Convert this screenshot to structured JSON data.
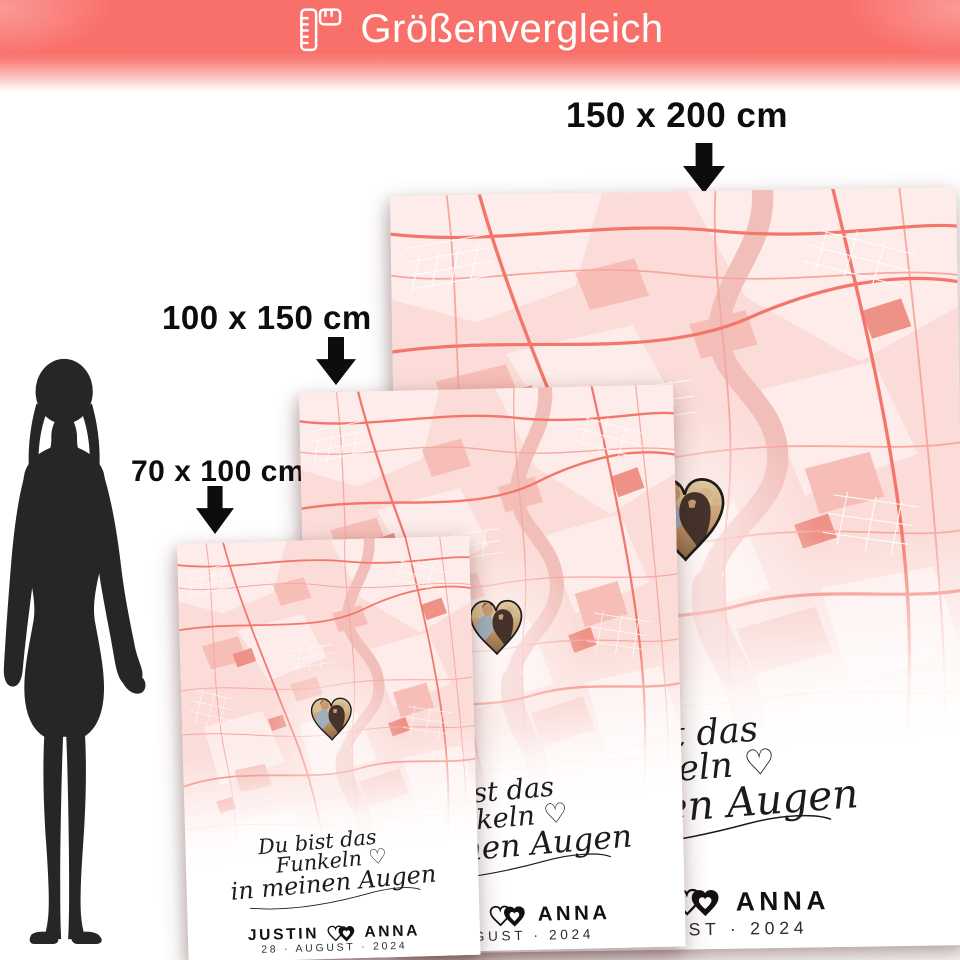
{
  "header": {
    "title": "Größenvergleich",
    "icon": "ruler-icon",
    "background_color": "#f9706a",
    "text_color": "#ffffff"
  },
  "size_callouts": [
    {
      "label": "150 x 200 cm"
    },
    {
      "label": "100 x 150 cm"
    },
    {
      "label": "70 x 100 cm"
    }
  ],
  "figure": {
    "icon": "female-silhouette",
    "color": "#262626"
  },
  "poster_design": {
    "script": {
      "line1": "Du bist das",
      "line2": "Funkeln ♡",
      "line3": "in meinen Augen"
    },
    "couple_names": {
      "first": "JUSTIN",
      "second": "ANNA"
    },
    "date": "28 · AUGUST · 2024",
    "map_colors": {
      "background": "#fbdcd8",
      "roads": "#f3766b",
      "river": "#f2beb9"
    }
  }
}
